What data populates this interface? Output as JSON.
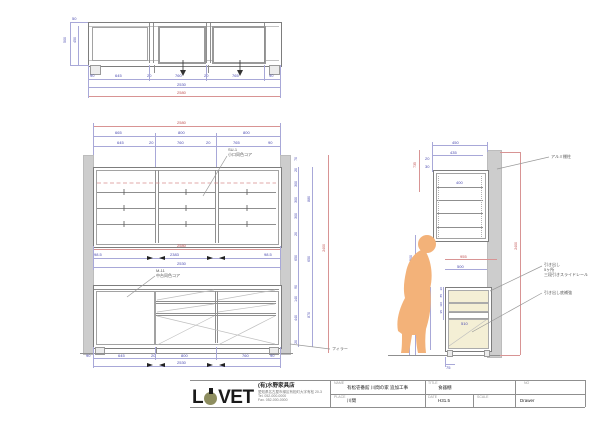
{
  "colors": {
    "dim_blue": "#4a4ab0",
    "dim_red": "#c05050",
    "wall_gray": "#cdcdcd",
    "drawer_cream": "#f4efd5",
    "figure_orange": "#f3b279",
    "logo_olive": "#8d8d5f"
  },
  "top_view": {
    "dim_50": "50",
    "dim_450": "450",
    "dim_500": "500",
    "chain": [
      "90",
      "645",
      "20",
      "760",
      "20",
      "765",
      "90"
    ],
    "subtotal": "2530",
    "total": "2580"
  },
  "front_view": {
    "total_top": "2580",
    "row2": [
      "665",
      "800",
      "800"
    ],
    "row3": [
      "645",
      "20",
      "760",
      "20",
      "765",
      "90"
    ],
    "upper_note_1": "SU-1",
    "upper_note_2": "小口同色コア",
    "lower_note_1": "M-11",
    "lower_note_2": "中台同色コア",
    "mid_total": "2580",
    "mid_row": [
      "98.5",
      "2383",
      "98.5"
    ],
    "mid_subtotal": "2530",
    "filler_note": "フィラー",
    "bottom_chain": [
      "90",
      "645",
      "20",
      "800",
      "760",
      "90"
    ],
    "bottom_subtotal": "2530",
    "right_chain_a": [
      "70",
      "20",
      "300",
      "300",
      "300",
      "20",
      "650",
      "90",
      "140",
      "440",
      "20"
    ],
    "right_chain_b": [
      "880",
      "650",
      "870"
    ],
    "right_total": "2400"
  },
  "side_view": {
    "depth_total": "450",
    "depth_inner": "435",
    "shelf_depth": "400",
    "top_small_1": "20",
    "top_small_2": "30",
    "upper_red": "735",
    "counter_red": "955",
    "counter_inner": "500",
    "figure_height": "1500",
    "hand_height": "560",
    "drawer_chain": [
      "20",
      "85",
      "110",
      "95"
    ],
    "drawer_stack": "440",
    "drawer_width": "510",
    "base_height": "75",
    "height_total": "2400",
    "note_shelf": "アルミ棚柱",
    "note_drawer_1": "引き出し",
    "note_drawer_2": "5ヶ所",
    "note_drawer_3": "三段引きスライドレール",
    "note_drawer_btm": "引き出し底補強"
  },
  "title_block": {
    "logo_l": "L",
    "logo_vet": "VET",
    "company": "(有)水野家具店",
    "address": "愛知県名古屋市緑区有松町大字有松 20-3",
    "tel": "Tel. 052-000-0000",
    "fax": "Fax. 052-000-0000",
    "label_name": "NAME",
    "label_place": "PLACE",
    "label_title": "TITLE",
    "label_date": "DATE",
    "label_scale": "SCALE",
    "label_no": "NO",
    "value_name": "有松壱番館 川間の家 追加工事",
    "value_place": "川間",
    "value_title": "食器棚",
    "value_date": "H31.5",
    "value_no": "Drawer"
  }
}
